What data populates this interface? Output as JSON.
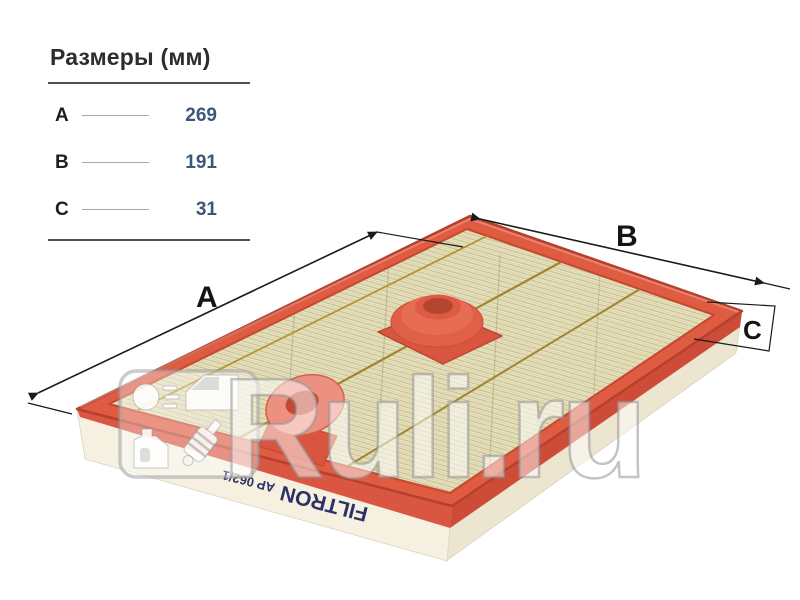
{
  "dimensions_panel": {
    "title": "Размеры (мм)",
    "rows": [
      {
        "label": "A",
        "value": "269"
      },
      {
        "label": "B",
        "value": "191"
      },
      {
        "label": "C",
        "value": "31"
      }
    ],
    "value_color": "#3b5878"
  },
  "product_image": {
    "description": "panel air filter shown in perspective with dimension arrows",
    "brand_text": "FILTRON",
    "part_number_text": "AP 062/1",
    "dimension_labels": {
      "a": "A",
      "b": "B",
      "c": "C"
    },
    "colors": {
      "frame_red": "#df5b42",
      "frame_dark_red": "#b5402c",
      "media_cream": "#e9e4c2",
      "pleat_line": "#cfc79c",
      "glue_line": "#a1852e",
      "side_paper_white": "#f5f0e0",
      "brand_navy": "#2c3166",
      "dimension_line": "#1a1a1a"
    }
  },
  "watermark": {
    "text": "Ruli.ru",
    "logo_icons": [
      "headlight-icon",
      "car-door-icon",
      "oil-canister-icon",
      "shock-absorber-icon"
    ]
  }
}
